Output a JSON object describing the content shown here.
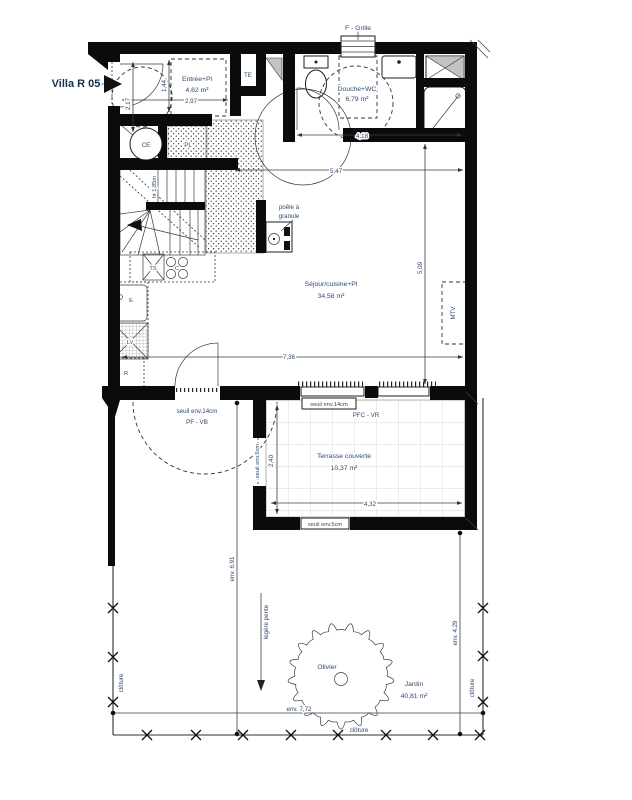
{
  "title": "Villa R 05",
  "colors": {
    "text": "#2b4a6f",
    "wall": "#0b0b0b",
    "tile_grid": "#d8d8d8"
  },
  "rooms": {
    "entree": {
      "name": "Entrée+Pl",
      "area": "4,62 m²"
    },
    "douche": {
      "name": "Douche+WC",
      "area": "6,79 m²"
    },
    "sejour": {
      "name": "Séjour/cuisine+Pl",
      "area": "34,58 m²"
    },
    "terrasse": {
      "name": "Terrasse couverte",
      "area": "10,37 m²"
    },
    "jardin": {
      "name": "Jardin",
      "area": "40,81 m²"
    }
  },
  "equipment": {
    "grille": "F  -  Grille",
    "te": "TE",
    "ce": "CE",
    "pl": "PL",
    "mtv": "MTV",
    "ts": "TS",
    "cooktop": "C",
    "sink": "E",
    "dishwasher": "LV",
    "fridge": "R",
    "stove_l1": "poêle à",
    "stove_l2": "granule",
    "stair_height": "ht 1,85m",
    "tree": "Olivier"
  },
  "dimensions": {
    "d297": "2,97",
    "d144": "1,44",
    "d217": "2,17",
    "d418": "4,18",
    "d547": "5,47",
    "d509": "5,09",
    "d736": "7,36",
    "d432": "4,32",
    "d240": "2,40",
    "d691": "env. 6,91",
    "d429": "env. 4,29",
    "d772": "env. 7,72"
  },
  "annotations": {
    "seuil14_door": "seuil env.14cm",
    "door_type": "PF  -  VB",
    "seuil14_bay": "seuil env.14cm",
    "bay_type": "PFC  -  VR",
    "seuil5_left": "seuil env.5cm",
    "seuil5_bottom": "seuil env.5cm",
    "slope": "légère pente",
    "fence_left": "clôture",
    "fence_right": "clôture",
    "fence_bottom": "clôture"
  }
}
